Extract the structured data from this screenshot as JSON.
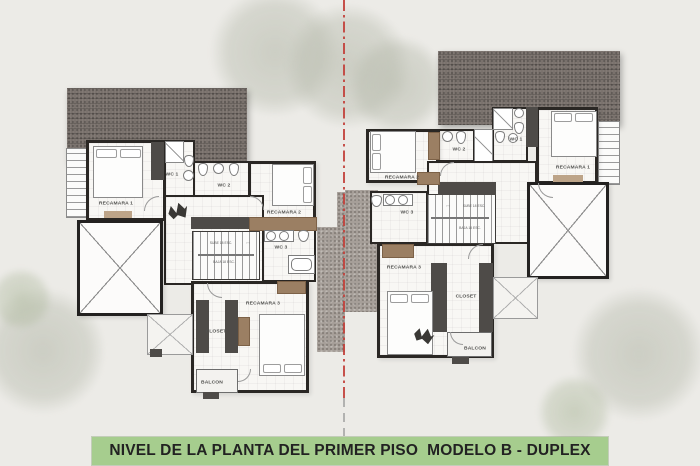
{
  "title": {
    "text": "NIVEL DE LA PLANTA DEL PRIMER PISO  MODELO B - DUPLEX"
  },
  "colors": {
    "background": "#ecebe7",
    "title_bg": "#a6cd8e",
    "roof": "#7b736e",
    "courtyard": "#a69f99",
    "wall": "#2a2724",
    "wood_accent": "#9b7f63",
    "centerline_red": "#c2403a"
  },
  "units": {
    "left": {
      "name": "left-duplex-unit",
      "rooms": {
        "recamara1": "RECAMARA 1",
        "recamara2": "RECAMARA 2",
        "recamara3": "RECAMARA 3",
        "wc1": "WC 1",
        "wc2": "WC 2",
        "wc3": "WC 3",
        "closet": "CLOSET",
        "balcon": "BALCON",
        "stairs_up": "SUBE 18 ESC.",
        "stairs_down": "BAJA 18 ESC.",
        "stairs_arrows": "› ‹"
      }
    },
    "right": {
      "name": "right-duplex-unit",
      "rooms": {
        "recamara1": "RECAMARA 1",
        "recamara2": "RECAMARA 2",
        "recamara3": "RECAMARA 3",
        "wc1": "WC 1",
        "wc2": "WC 2",
        "wc3": "WC 3",
        "closet": "CLOSET",
        "balcon": "BALCON",
        "stairs_up": "SUBE 18 ESC.",
        "stairs_down": "BAJA 18 ESC.",
        "stairs_arrows": "› ‹"
      }
    }
  }
}
